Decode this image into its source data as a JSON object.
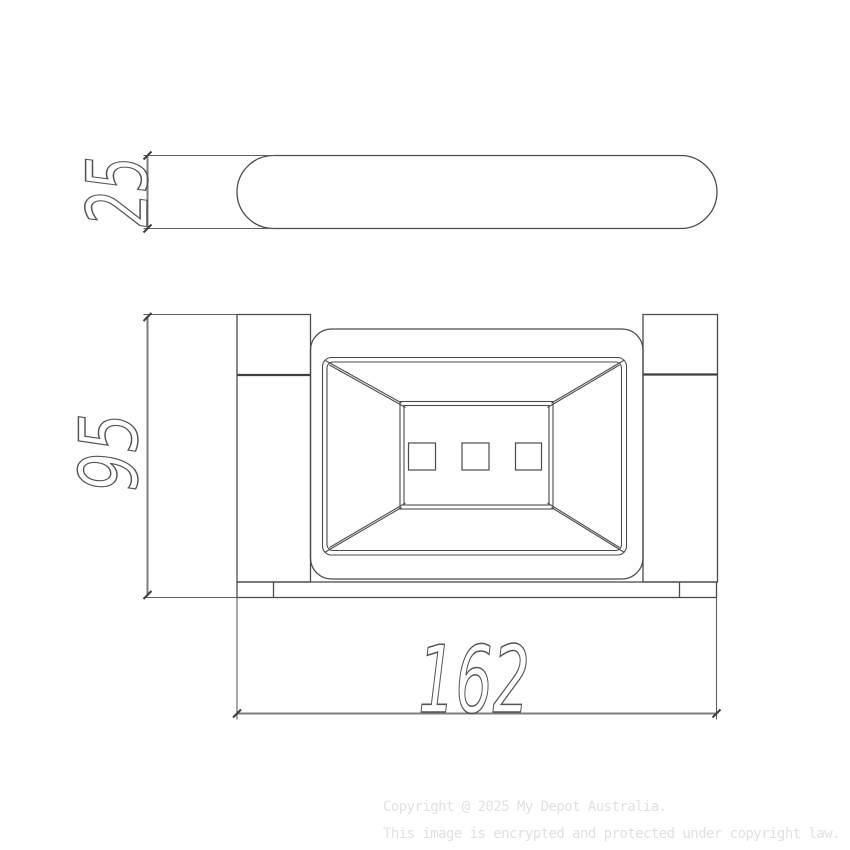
{
  "dimensions": {
    "top_view_height": "25",
    "front_view_height": "95",
    "front_view_width": "162"
  },
  "watermark": {
    "line1": "Copyright @ 2025 My Depot Australia.",
    "line2": "This image is encrypted and protected under copyright law."
  },
  "colors": {
    "background": "#ffffff",
    "line": "#4c4c4c",
    "line_heavy": "#3e3e3e",
    "dimension": "#7e7e7e",
    "extension": "#5f5f5f",
    "text_outline": "#555555",
    "watermark": "#e0e0e0"
  }
}
